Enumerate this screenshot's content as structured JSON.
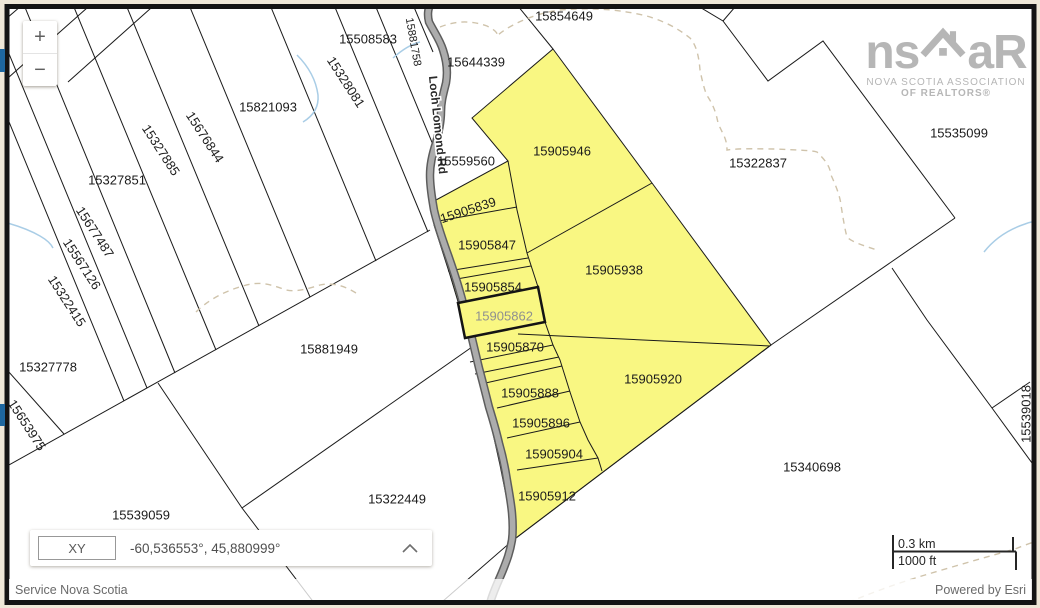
{
  "map": {
    "road_label": "Loch Lomond Rd",
    "attribution": {
      "left": "Service Nova Scotia",
      "right": "Powered by Esri"
    },
    "scalebar": {
      "km": "0.3 km",
      "ft": "1000 ft"
    },
    "coordinate_widget": {
      "label": "XY",
      "value": "-60,536553°, 45,880999°"
    },
    "controls": {
      "zoom_in": "+",
      "zoom_out": "−"
    },
    "logo": {
      "word_left": "ns",
      "word_right": "aR",
      "sub1": "NOVA SCOTIA ASSOCIATION",
      "sub2": "OF REALTORS®"
    },
    "colors": {
      "highlight_yellow": "#f9f782",
      "selected_label_gray": "#8f9090",
      "road_gray": "#acacac",
      "blue_tab": "#1e679f",
      "page_beige": "#efe8d8"
    },
    "parcels": [
      {
        "id": "15508583",
        "x": 368,
        "y": 39,
        "r": 0
      },
      {
        "id": "15854649",
        "x": 564,
        "y": 16,
        "r": 0
      },
      {
        "id": "15644339",
        "x": 476,
        "y": 62,
        "r": 0
      },
      {
        "id": "15821093",
        "x": 268,
        "y": 107,
        "r": 0
      },
      {
        "id": "15328081",
        "x": 346,
        "y": 82,
        "r": 57
      },
      {
        "id": "15881758",
        "x": 413,
        "y": 42,
        "r": 80,
        "small": true
      },
      {
        "id": "15327885",
        "x": 161,
        "y": 150,
        "r": 57
      },
      {
        "id": "15676844",
        "x": 205,
        "y": 137,
        "r": 57
      },
      {
        "id": "15327851",
        "x": 117,
        "y": 180,
        "r": 0
      },
      {
        "id": "15559560",
        "x": 466,
        "y": 161,
        "r": 0
      },
      {
        "id": "15905946",
        "x": 562,
        "y": 151,
        "r": 0
      },
      {
        "id": "15322837",
        "x": 758,
        "y": 163,
        "r": 0
      },
      {
        "id": "15535099",
        "x": 959,
        "y": 133,
        "r": 0
      },
      {
        "id": "15677487",
        "x": 95,
        "y": 232,
        "r": 57
      },
      {
        "id": "15567126",
        "x": 82,
        "y": 264,
        "r": 57
      },
      {
        "id": "15322415",
        "x": 67,
        "y": 301,
        "r": 57
      },
      {
        "id": "15905839",
        "x": 468,
        "y": 210,
        "r": -18
      },
      {
        "id": "15905847",
        "x": 487,
        "y": 245,
        "r": 0
      },
      {
        "id": "15905854",
        "x": 493,
        "y": 287,
        "r": 0
      },
      {
        "id": "15905862",
        "x": 504,
        "y": 316,
        "r": 0,
        "selected": true
      },
      {
        "id": "15905870",
        "x": 515,
        "y": 347,
        "r": 0
      },
      {
        "id": "15905938",
        "x": 614,
        "y": 270,
        "r": 0
      },
      {
        "id": "15881949",
        "x": 329,
        "y": 349,
        "r": 0
      },
      {
        "id": "15327778",
        "x": 48,
        "y": 367,
        "r": 0
      },
      {
        "id": "15653975",
        "x": 27,
        "y": 425,
        "r": 57
      },
      {
        "id": "15905888",
        "x": 530,
        "y": 393,
        "r": 0
      },
      {
        "id": "15905896",
        "x": 541,
        "y": 423,
        "r": 0
      },
      {
        "id": "15905904",
        "x": 554,
        "y": 454,
        "r": 0
      },
      {
        "id": "15905912",
        "x": 547,
        "y": 496,
        "r": 0
      },
      {
        "id": "15905920",
        "x": 653,
        "y": 379,
        "r": 0
      },
      {
        "id": "15340698",
        "x": 812,
        "y": 467,
        "r": 0
      },
      {
        "id": "15539018",
        "x": 1026,
        "y": 414,
        "r": -90
      },
      {
        "id": "15322449",
        "x": 397,
        "y": 499,
        "r": 0
      },
      {
        "id": "15539059",
        "x": 141,
        "y": 515,
        "r": 0
      }
    ]
  }
}
